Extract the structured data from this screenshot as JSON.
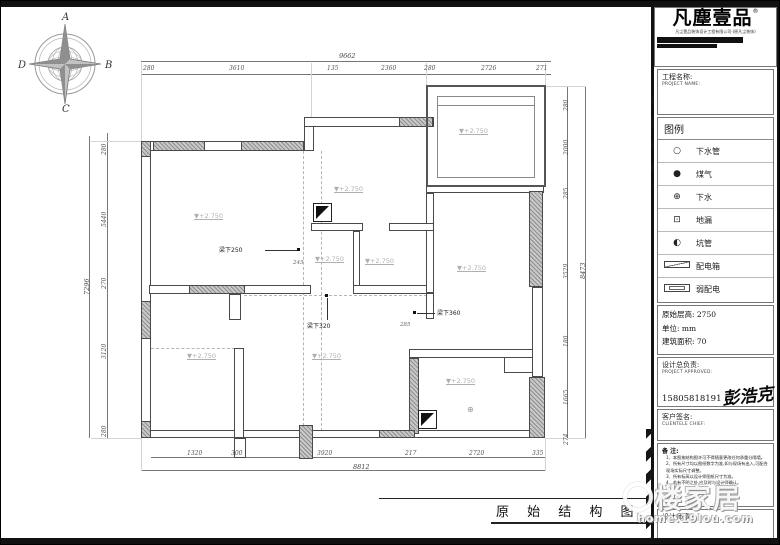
{
  "logo": {
    "name": "凡塵壹品",
    "reg": "®",
    "tagline": "凡尘壹品装饰设计工程有限公司·(原凡尘装饰)"
  },
  "project": {
    "label_cn": "工程名称:",
    "label_en": "PROJECT NAME:"
  },
  "legend": {
    "title": "图例",
    "items": [
      {
        "type": "glyph",
        "symbol": "○",
        "label": "下水管",
        "name": "downpipe-icon"
      },
      {
        "type": "glyph",
        "symbol": "●",
        "label": "煤气",
        "name": "gas-icon"
      },
      {
        "type": "glyph",
        "symbol": "⊕",
        "label": "下水",
        "name": "drain-icon"
      },
      {
        "type": "glyph",
        "symbol": "⊡",
        "label": "地漏",
        "name": "floor-drain-icon"
      },
      {
        "type": "glyph",
        "symbol": "◐",
        "label": "坑管",
        "name": "pit-pipe-icon"
      },
      {
        "type": "icon-dist",
        "symbol": "",
        "label": "配电箱",
        "name": "distribution-box-icon"
      },
      {
        "type": "icon-weak",
        "symbol": "",
        "label": "弱配电",
        "name": "weak-current-icon"
      }
    ]
  },
  "specs": {
    "height": "原始层高: 2750",
    "unit": "单位: mm",
    "area": "建筑面积: 70"
  },
  "approval": {
    "label_cn": "设计总负责:",
    "label_en": "PROJECT APPROVED:",
    "phone": "15805818191",
    "signature": "彭浩克"
  },
  "client": {
    "label_cn": "客户签名:",
    "label_en": "CLIENTELE CHIEF:"
  },
  "notes": {
    "title": "备  注:",
    "items": [
      "1、本图按结构图许可不得随意更改任何承重分隔墙。",
      "2、所有尺寸均以图纸数字为准,如与现场有出入,可配合现场实际尺寸调整。",
      "3、所有标高以设计师图纸尺寸为准。",
      "4、若有不明之处,应及时与设计师确认。"
    ]
  },
  "designer_seal": {
    "label": "设计师章:"
  },
  "title_block": {
    "title": "原 始 结 构 图"
  },
  "watermark": {
    "text": "楼家居",
    "url": "home.19lou.com"
  },
  "compass": {
    "n": "A",
    "e": "B",
    "s": "C",
    "w": "D"
  },
  "dims": {
    "top_overall": {
      "t": "9662",
      "x": 338,
      "y": 45
    },
    "top": [
      {
        "t": "280",
        "x": 142,
        "y": 58
      },
      {
        "t": "3610",
        "x": 228,
        "y": 58
      },
      {
        "t": "135",
        "x": 326,
        "y": 58
      },
      {
        "t": "2360",
        "x": 380,
        "y": 58
      },
      {
        "t": "280",
        "x": 423,
        "y": 58
      },
      {
        "t": "2726",
        "x": 480,
        "y": 58
      },
      {
        "t": "271",
        "x": 535,
        "y": 58
      }
    ],
    "left_overall": {
      "t": "7296",
      "x": 82,
      "y": 288
    },
    "left": [
      {
        "t": "280",
        "y": 148
      },
      {
        "t": "5440",
        "y": 220
      },
      {
        "t": "270",
        "y": 282
      },
      {
        "t": "3120",
        "y": 352
      },
      {
        "t": "280",
        "y": 430
      }
    ],
    "right_overall": {
      "t": "8473",
      "x": 578,
      "y": 272
    },
    "right": [
      {
        "t": "280",
        "y": 104
      },
      {
        "t": "2000",
        "y": 148
      },
      {
        "t": "285",
        "y": 192
      },
      {
        "t": "3529",
        "y": 272
      },
      {
        "t": "180",
        "y": 340
      },
      {
        "t": "1665",
        "y": 398
      },
      {
        "t": "274",
        "y": 438
      }
    ],
    "bottom_overall": {
      "t": "8812",
      "x": 352,
      "y": 456
    },
    "bottom": [
      {
        "t": "1320",
        "x": 186,
        "y": 443
      },
      {
        "t": "300",
        "x": 230,
        "y": 443
      },
      {
        "t": "3920",
        "x": 316,
        "y": 443
      },
      {
        "t": "217",
        "x": 404,
        "y": 443
      },
      {
        "t": "2720",
        "x": 468,
        "y": 443
      },
      {
        "t": "335",
        "x": 531,
        "y": 443
      }
    ]
  },
  "plan": {
    "elevation_text": "▼+2.750",
    "elevations": [
      {
        "x": 193,
        "y": 205
      },
      {
        "x": 333,
        "y": 178
      },
      {
        "x": 458,
        "y": 120
      },
      {
        "x": 314,
        "y": 248
      },
      {
        "x": 364,
        "y": 250
      },
      {
        "x": 456,
        "y": 257
      },
      {
        "x": 186,
        "y": 345
      },
      {
        "x": 311,
        "y": 345
      },
      {
        "x": 445,
        "y": 370
      }
    ],
    "beams": [
      {
        "t": "梁下250",
        "x": 218,
        "y": 238,
        "line": [
          264,
          243,
          32,
          1
        ],
        "dot": [
          296,
          241
        ]
      },
      {
        "t": "梁下320",
        "x": 306,
        "y": 314,
        "line": [
          326,
          291,
          1,
          22
        ],
        "dot": [
          324,
          287
        ]
      },
      {
        "t": "梁下360",
        "x": 436,
        "y": 301,
        "line": [
          416,
          306,
          18,
          1
        ],
        "dot": [
          412,
          304
        ]
      }
    ],
    "small_dims": [
      {
        "t": "245",
        "x": 292,
        "y": 253
      },
      {
        "t": "285",
        "x": 399,
        "y": 315
      }
    ],
    "symbols": [
      {
        "t": "⊕",
        "x": 466,
        "y": 398
      }
    ]
  }
}
